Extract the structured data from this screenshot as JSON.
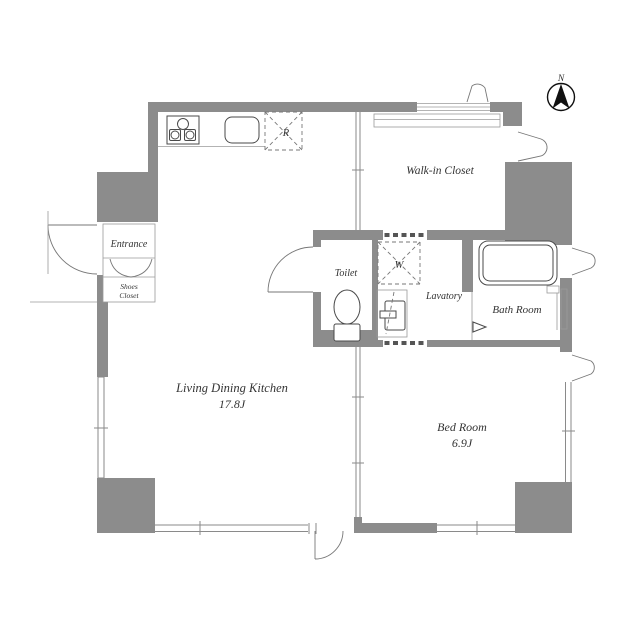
{
  "compass": {
    "north_label": "N"
  },
  "rooms": {
    "entrance": {
      "name": "Entrance"
    },
    "shoes_closet": {
      "name_line1": "Shoes",
      "name_line2": "Closet"
    },
    "toilet": {
      "name": "Toilet"
    },
    "lavatory": {
      "name": "Lavatory"
    },
    "bath_room": {
      "name": "Bath Room"
    },
    "walk_in_closet": {
      "name": "Walk-in Closet"
    },
    "living_dining_kitchen": {
      "name": "Living Dining Kitchen",
      "area": "17.8J"
    },
    "bed_room": {
      "name": "Bed Room",
      "area": "6.9J"
    }
  },
  "fixtures": {
    "refrigerator_space": {
      "label": "R"
    },
    "washing_machine_space": {
      "label": "W"
    }
  },
  "colors": {
    "wall": "#8c8c8c",
    "line": "#8a8a8a",
    "fixture_stroke": "#4a4a4a",
    "text": "#333333",
    "background": "#ffffff"
  }
}
